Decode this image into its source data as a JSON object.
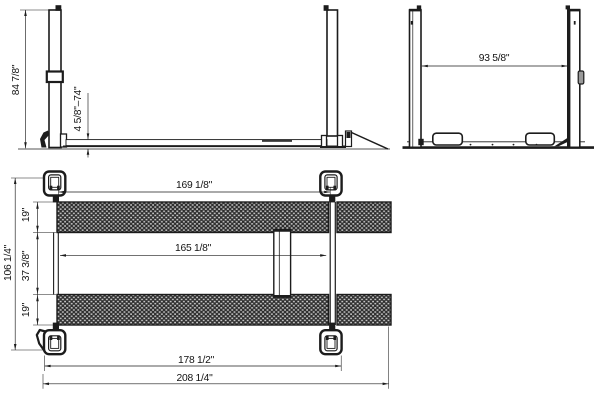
{
  "drawing": {
    "side_view": {
      "column_height": "84 7/8\"",
      "lift_height_range": "4 5/8\"–74\""
    },
    "end_view": {
      "width_between_columns": "93 5/8\""
    },
    "plan_view": {
      "length_between_columns_inner": "169 1/8\"",
      "runway_inner_length": "165 1/8\"",
      "runway_width_top": "19\"",
      "distance_between_runways": "37 3/8\"",
      "runway_width_bottom": "19\"",
      "overall_width": "106 1/4\"",
      "column_outer_length": "178 1/2\"",
      "overall_length": "208 1/4\""
    }
  },
  "colors": {
    "line": "#1c1c1c",
    "background": "#ffffff",
    "tread_dark": "#2e2e2e",
    "tread_light": "#c6c6c6"
  }
}
